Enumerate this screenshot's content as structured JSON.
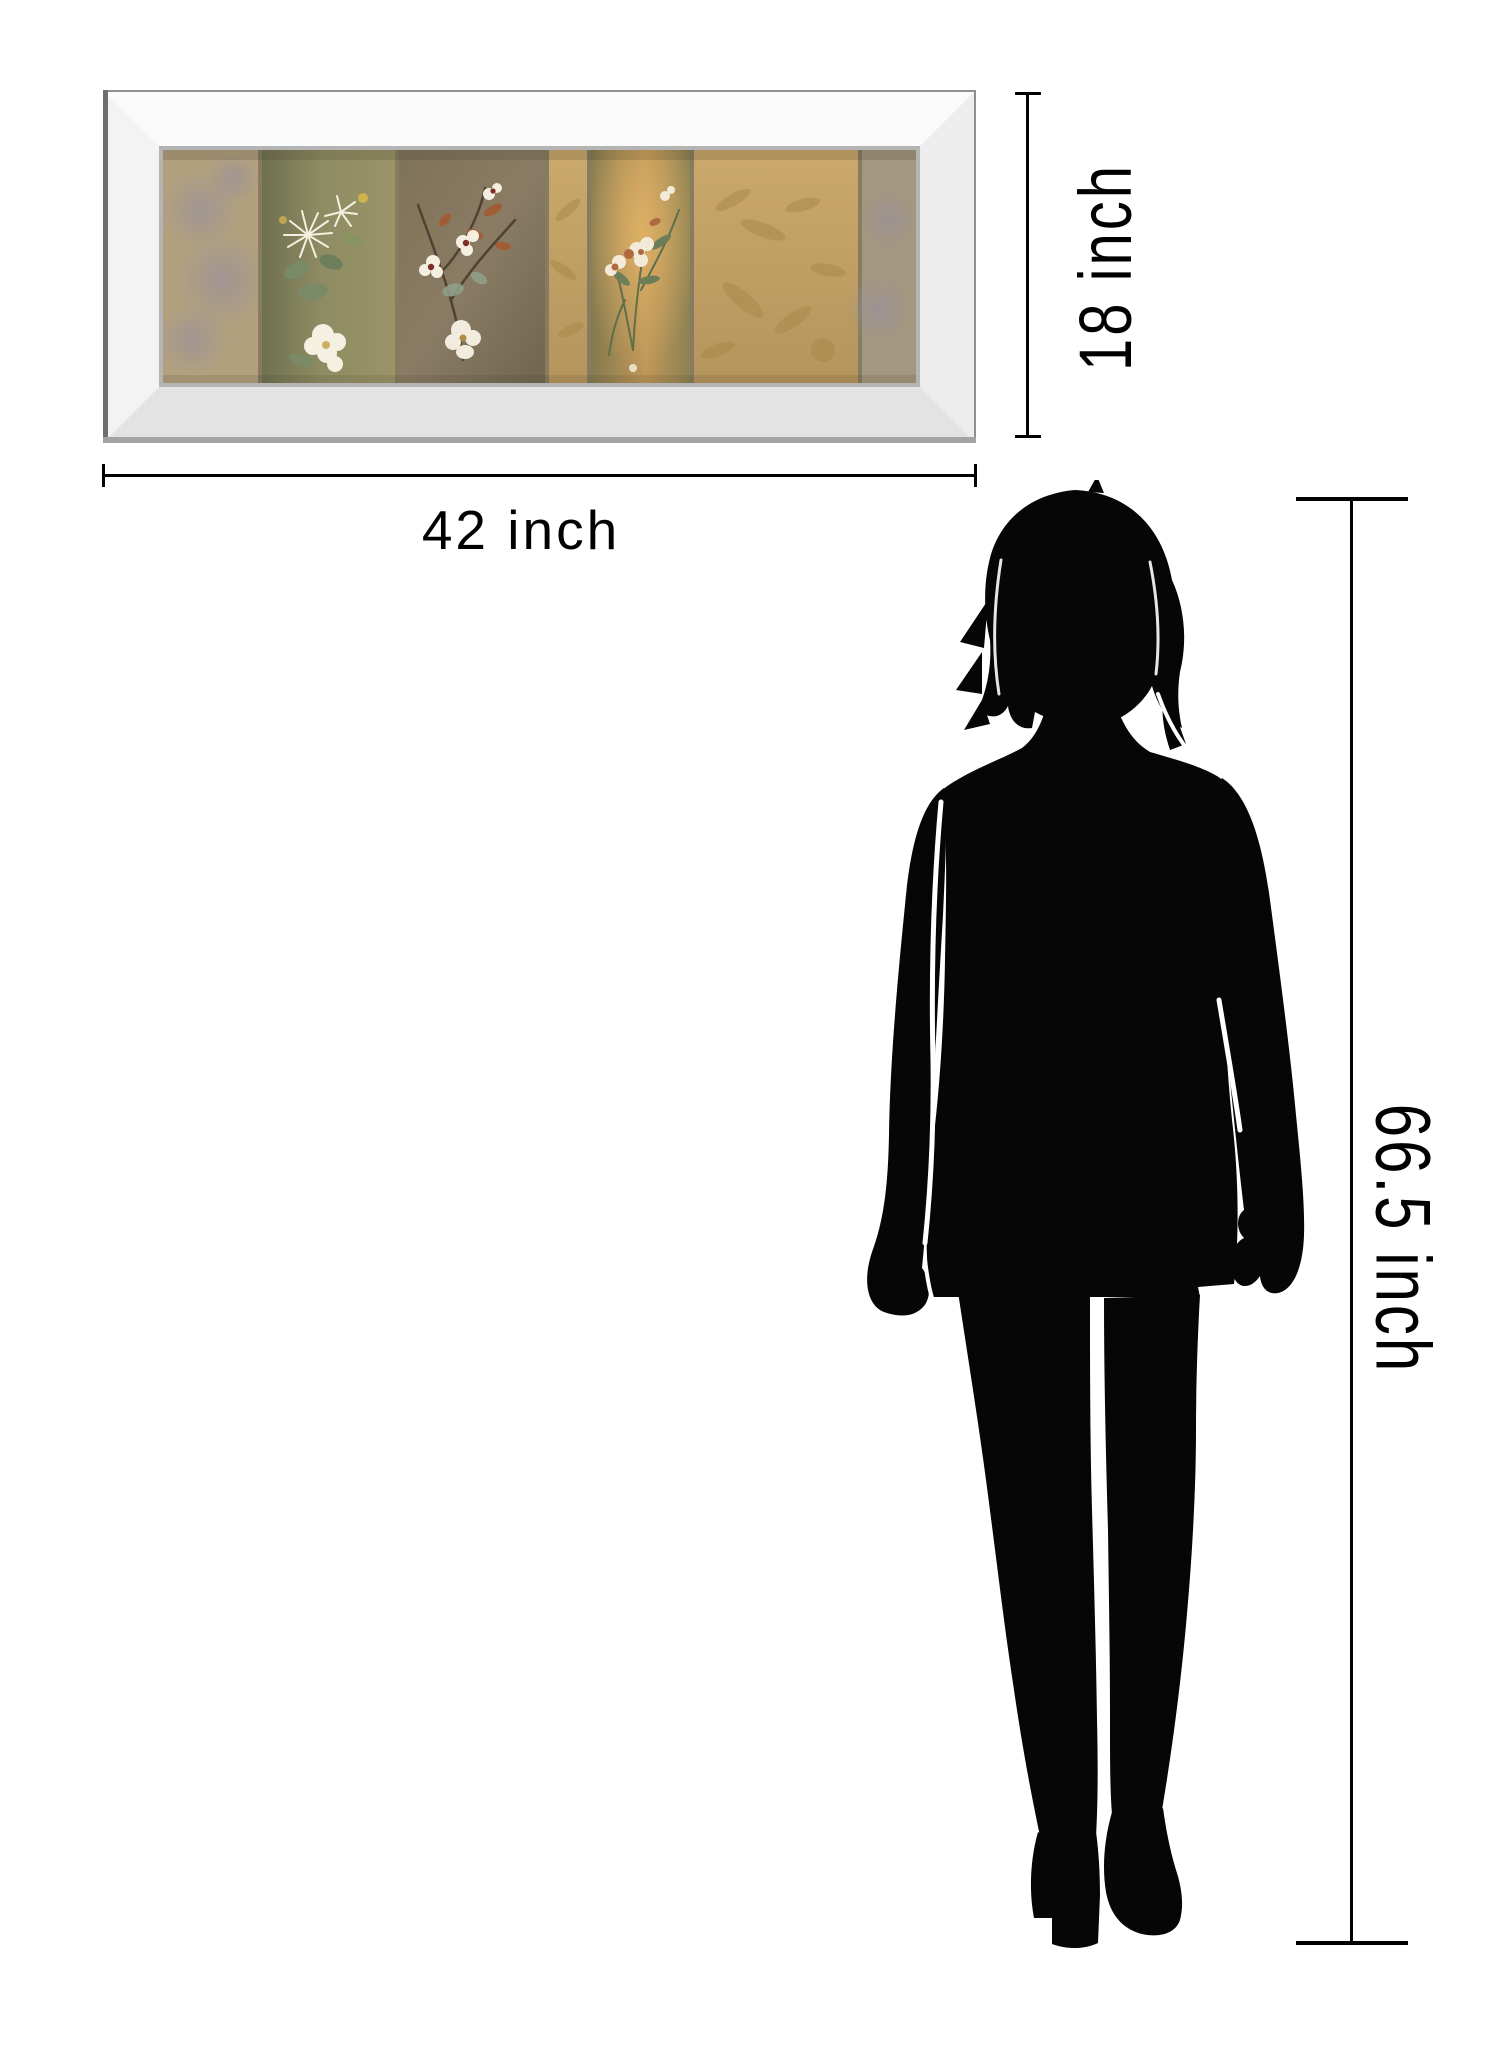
{
  "diagram": {
    "type": "product-size-comparison",
    "product": "mirror-framed floral panel wall art",
    "dimensions": {
      "artwork_width_label": "42 inch",
      "artwork_height_label": "18 inch",
      "person_height_label": "66.5 inch"
    },
    "reference_figure": "standing woman silhouette",
    "colors": {
      "background": "#ffffff",
      "dimension_line": "#000000",
      "label_text": "#000000",
      "silhouette": "#060606",
      "frame_bevel_light": "#fbfbfb",
      "frame_bevel_shade": "#e3e3e3",
      "frame_inner_lip": "#b4b4b4",
      "art_gold_panel": "#c2a066",
      "art_olive_panel": "#8e8c63",
      "art_grey_brown_panel": "#887a62",
      "art_mottle": "#9c93a1",
      "flower_white": "#f3efe0",
      "flower_crimson": "#7e2c28",
      "leaf_rust": "#a05c34",
      "leaf_sage": "#7a8a66"
    }
  }
}
